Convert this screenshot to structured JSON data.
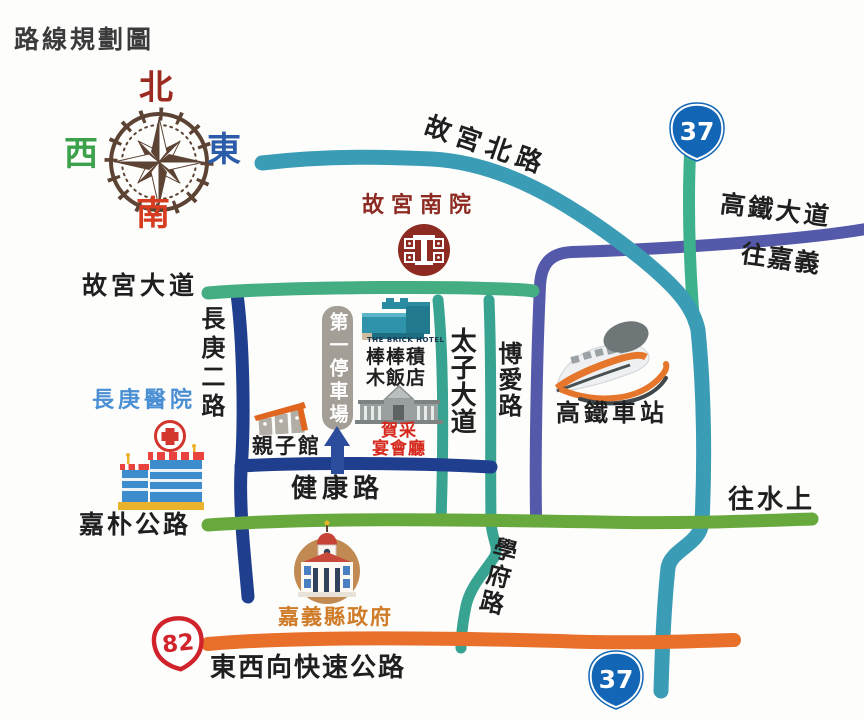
{
  "title": "路線規劃圖",
  "compass": {
    "north": "北",
    "south": "南",
    "east": "東",
    "west": "西"
  },
  "roads": {
    "gugong_north": "故宮北路",
    "hsr_boulevard": "高鐵大道",
    "to_chiayi": "往嘉義",
    "gugong_boulevard": "故宮大道",
    "changgung_2nd": "長庚二路",
    "taizi_boulevard": "太子大道",
    "boai": "博愛路",
    "jiankang": "健康路",
    "jiapu_highway": "嘉朴公路",
    "to_shuishang": "往水上",
    "xuefu": "學府路",
    "east_west_expressway": "東西向快速公路"
  },
  "shields": {
    "provincial_37_top": "37",
    "provincial_37_bottom": "37",
    "expressway_82": "82"
  },
  "landmarks": {
    "museum_label": "故宮南院",
    "hotel_en_label": "THE BRICK HOTEL",
    "hotel_zh_line1": "棒棒積",
    "hotel_zh_line2": "木飯店",
    "banquet_line1": "賀采",
    "banquet_line2": "宴會廳",
    "parking_label": "第一停車場",
    "family_center_label": "親子館",
    "hospital_label": "長庚醫院",
    "hsr_station_label": "高鐵車站",
    "county_gov_label": "嘉義縣政府"
  },
  "colors": {
    "road_teal": "#3b9cb6",
    "road_emerald": "#3cb18b",
    "road_green": "#45ad82",
    "road_grass": "#68a93e",
    "road_navy": "#1f3e8e",
    "road_purple": "#5459aa",
    "road_orange": "#e9702b",
    "shield_blue": "#1266b5",
    "shield_red": "#d0232b",
    "museum_red": "#8d2b22",
    "banquet_red": "#d5291d",
    "hospital_blue": "#4a8ed3",
    "gov_orange": "#cf7b28",
    "compass_brown": "#5d4333",
    "north_maroon": "#9b2b20",
    "east_blue": "#2b5ca9",
    "west_green": "#3ba24b",
    "south_red": "#d63c20"
  }
}
